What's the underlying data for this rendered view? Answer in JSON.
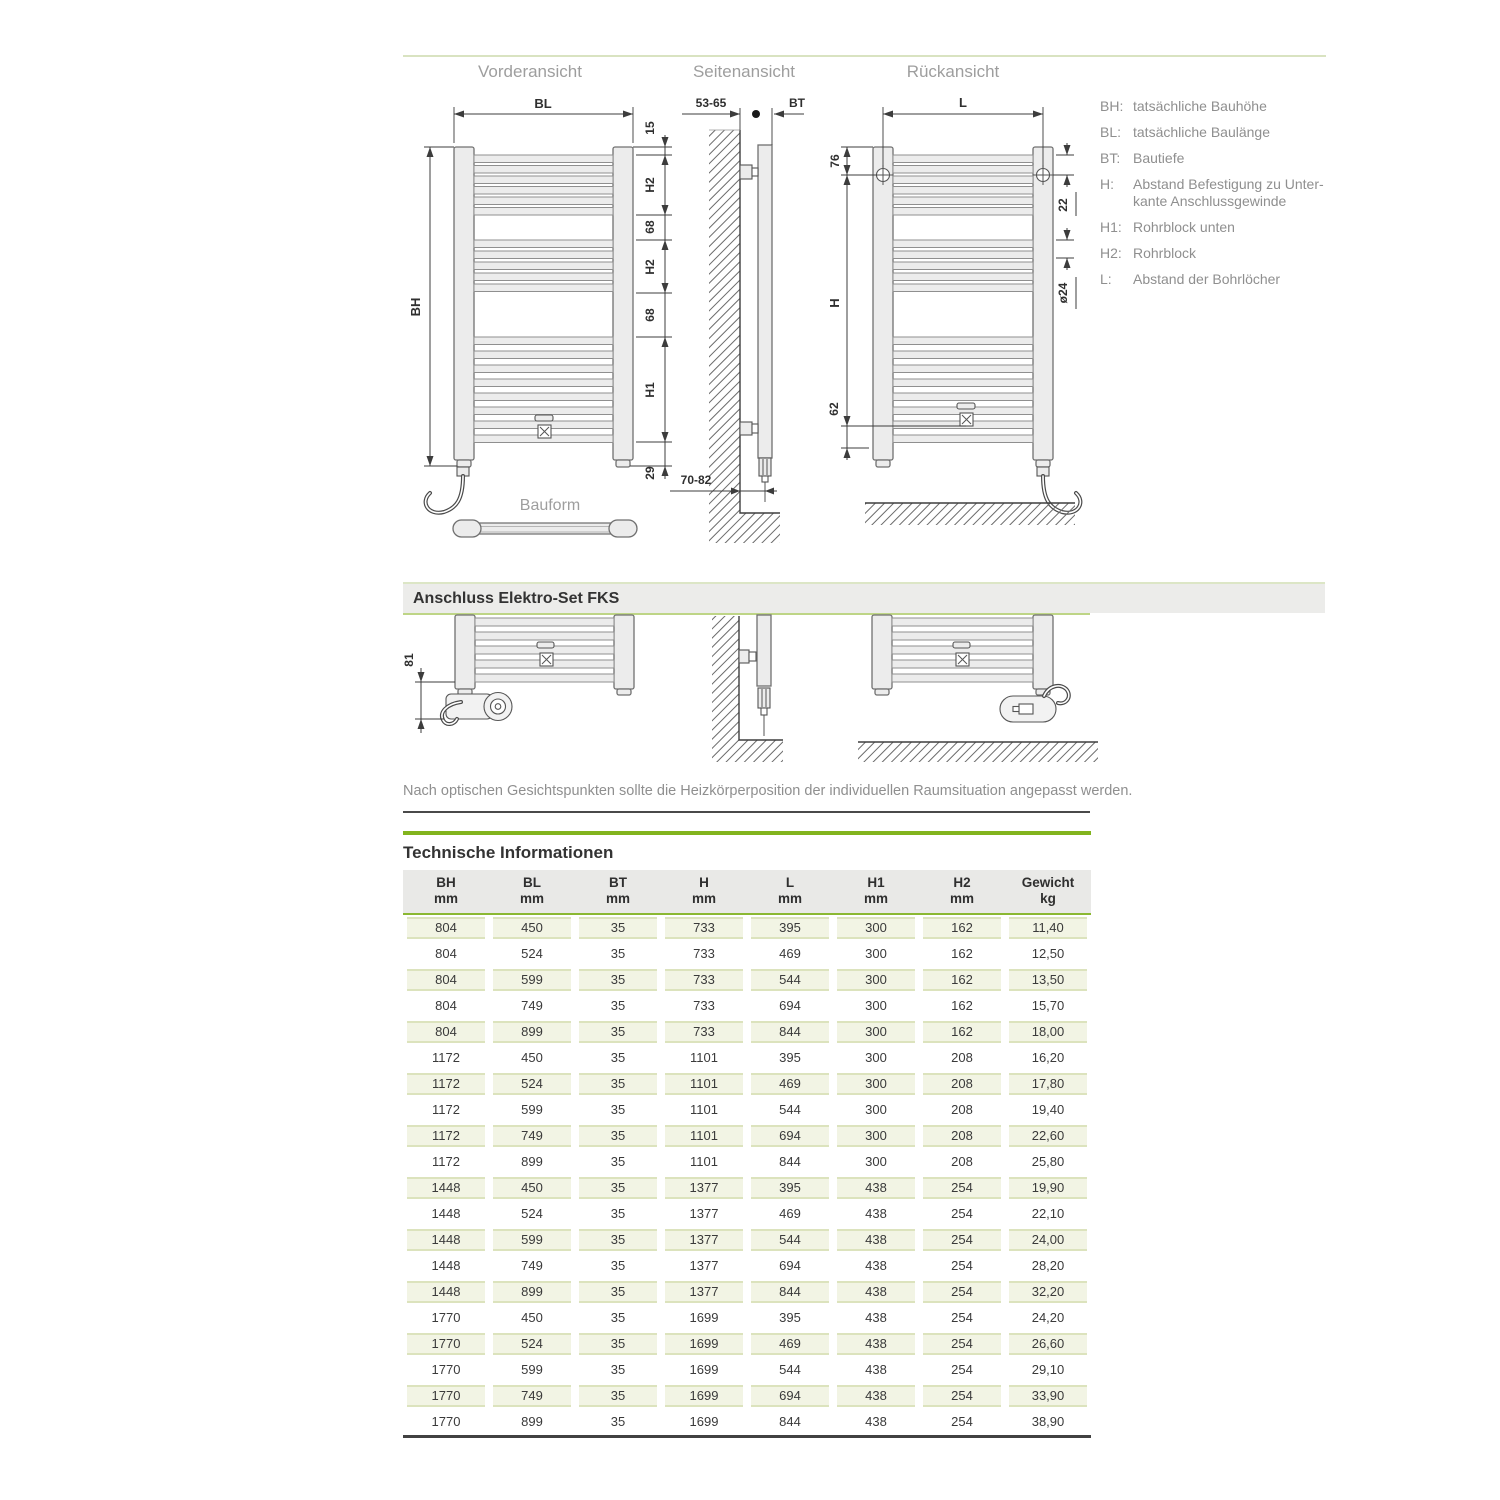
{
  "drawings": {
    "front_title": "Vorderansicht",
    "side_title": "Seitenansicht",
    "rear_title": "Rückansicht",
    "bauform": "Bauform",
    "dims": {
      "bl": "BL",
      "bh": "BH",
      "d15": "15",
      "h2": "H2",
      "d68": "68",
      "h1": "H1",
      "d29": "29",
      "wall_gap": "53-65",
      "bt": "BT",
      "floor_gap": "70-82",
      "l": "L",
      "d76": "76",
      "d22": "22",
      "dia": "ø24",
      "h": "H",
      "d62": "62",
      "d81": "81"
    }
  },
  "legend": {
    "items": [
      {
        "key": "BH:",
        "line1": "tatsächliche Bauhöhe",
        "line2": ""
      },
      {
        "key": "BL:",
        "line1": "tatsächliche Baulänge",
        "line2": ""
      },
      {
        "key": "BT:",
        "line1": "Bautiefe",
        "line2": ""
      },
      {
        "key": "H:",
        "line1": "Abstand Befestigung zu Unter-",
        "line2": "kante Anschlussgewinde"
      },
      {
        "key": "H1:",
        "line1": "Rohrblock unten",
        "line2": ""
      },
      {
        "key": "H2:",
        "line1": "Rohrblock",
        "line2": ""
      },
      {
        "key": "L:",
        "line1": "Abstand der Bohrlöcher",
        "line2": ""
      }
    ]
  },
  "elektro": {
    "title": "Anschluss Elektro-Set FKS"
  },
  "note": "Nach optischen Gesichtspunkten sollte die Heizkörperposition der individuellen Raumsituation angepasst werden.",
  "table": {
    "title": "Technische Informationen",
    "columns": [
      {
        "label": "BH",
        "unit": "mm"
      },
      {
        "label": "BL",
        "unit": "mm"
      },
      {
        "label": "BT",
        "unit": "mm"
      },
      {
        "label": "H",
        "unit": "mm"
      },
      {
        "label": "L",
        "unit": "mm"
      },
      {
        "label": "H1",
        "unit": "mm"
      },
      {
        "label": "H2",
        "unit": "mm"
      },
      {
        "label": "Gewicht",
        "unit": "kg"
      }
    ],
    "rows": [
      [
        "804",
        "450",
        "35",
        "733",
        "395",
        "300",
        "162",
        "11,40"
      ],
      [
        "804",
        "524",
        "35",
        "733",
        "469",
        "300",
        "162",
        "12,50"
      ],
      [
        "804",
        "599",
        "35",
        "733",
        "544",
        "300",
        "162",
        "13,50"
      ],
      [
        "804",
        "749",
        "35",
        "733",
        "694",
        "300",
        "162",
        "15,70"
      ],
      [
        "804",
        "899",
        "35",
        "733",
        "844",
        "300",
        "162",
        "18,00"
      ],
      [
        "1172",
        "450",
        "35",
        "1101",
        "395",
        "300",
        "208",
        "16,20"
      ],
      [
        "1172",
        "524",
        "35",
        "1101",
        "469",
        "300",
        "208",
        "17,80"
      ],
      [
        "1172",
        "599",
        "35",
        "1101",
        "544",
        "300",
        "208",
        "19,40"
      ],
      [
        "1172",
        "749",
        "35",
        "1101",
        "694",
        "300",
        "208",
        "22,60"
      ],
      [
        "1172",
        "899",
        "35",
        "1101",
        "844",
        "300",
        "208",
        "25,80"
      ],
      [
        "1448",
        "450",
        "35",
        "1377",
        "395",
        "438",
        "254",
        "19,90"
      ],
      [
        "1448",
        "524",
        "35",
        "1377",
        "469",
        "438",
        "254",
        "22,10"
      ],
      [
        "1448",
        "599",
        "35",
        "1377",
        "544",
        "438",
        "254",
        "24,00"
      ],
      [
        "1448",
        "749",
        "35",
        "1377",
        "694",
        "438",
        "254",
        "28,20"
      ],
      [
        "1448",
        "899",
        "35",
        "1377",
        "844",
        "438",
        "254",
        "32,20"
      ],
      [
        "1770",
        "450",
        "35",
        "1699",
        "395",
        "438",
        "254",
        "24,20"
      ],
      [
        "1770",
        "524",
        "35",
        "1699",
        "469",
        "438",
        "254",
        "26,60"
      ],
      [
        "1770",
        "599",
        "35",
        "1699",
        "544",
        "438",
        "254",
        "29,10"
      ],
      [
        "1770",
        "749",
        "35",
        "1699",
        "694",
        "438",
        "254",
        "33,90"
      ],
      [
        "1770",
        "899",
        "35",
        "1699",
        "844",
        "438",
        "254",
        "38,90"
      ]
    ]
  },
  "colors": {
    "accent_green": "#82b41e",
    "light_green_line": "#d9e3c1",
    "stripe_bg": "#f2f4e4",
    "stripe_border": "#dce3bd",
    "header_bg": "#e9e9e7",
    "bar_bg": "#ececea"
  }
}
